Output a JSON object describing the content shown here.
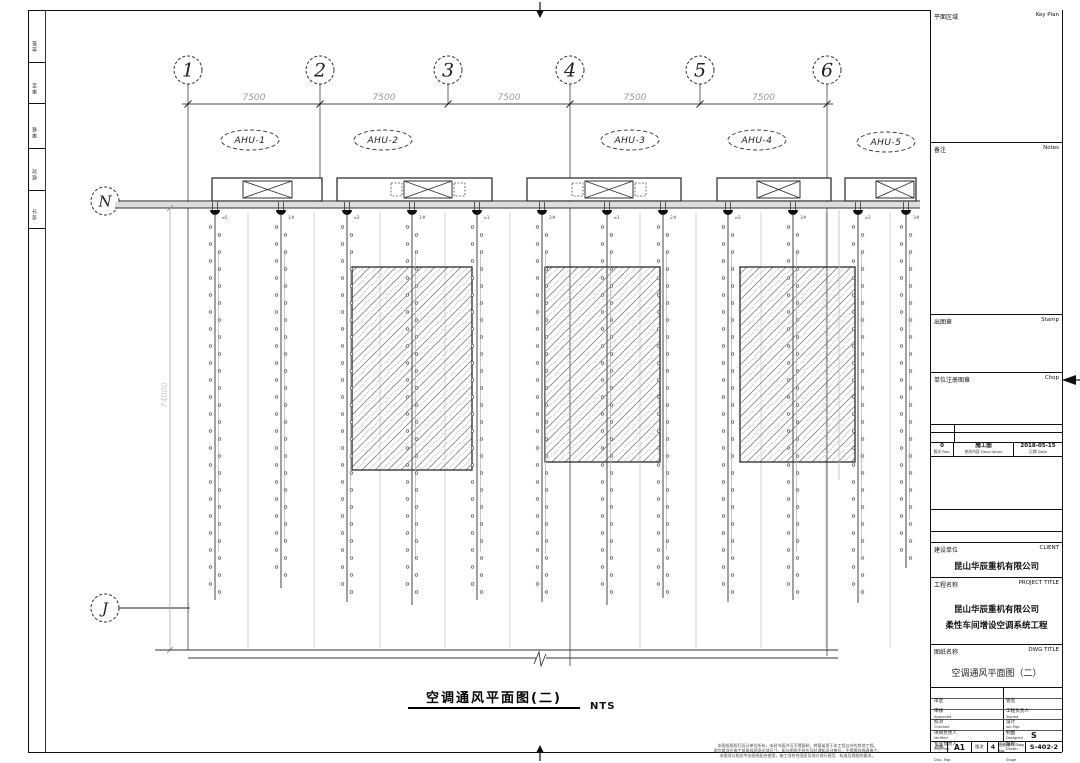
{
  "main_title": {
    "text": "空调通风平面图(二)",
    "scale": "NTS"
  },
  "margin_labels": [
    "会签",
    "审定",
    "审核",
    "校对",
    "设计"
  ],
  "plan": {
    "bubble_y": 70,
    "bubble_r": 14,
    "dim_line_y": 104,
    "grid_cols": [
      {
        "label": "1",
        "x": 188,
        "stem_to": 650
      },
      {
        "label": "2",
        "x": 320,
        "stem_to": 208
      },
      {
        "label": "3",
        "x": 448,
        "stem_to": 104
      },
      {
        "label": "4",
        "x": 570,
        "stem_to": 666
      },
      {
        "label": "5",
        "x": 700,
        "stem_to": 104
      },
      {
        "label": "6",
        "x": 827,
        "stem_to": 656
      }
    ],
    "dims": [
      {
        "text": "7500",
        "x1": 188,
        "x2": 320
      },
      {
        "text": "7500",
        "x1": 320,
        "x2": 448
      },
      {
        "text": "7500",
        "x1": 448,
        "x2": 570
      },
      {
        "text": "7500",
        "x1": 570,
        "x2": 700
      },
      {
        "text": "7500",
        "x1": 700,
        "x2": 827
      }
    ],
    "grid_rows": [
      {
        "label": "N",
        "y": 201,
        "line_x1": 119,
        "line_x2": 920
      },
      {
        "label": "J",
        "y": 608,
        "line_x1": 119,
        "line_x2": 190
      }
    ],
    "row_bubble_x": 105,
    "vert_dim": {
      "text": "74000",
      "x": 170,
      "y1": 208,
      "y2": 650,
      "ty": 395
    },
    "ahu_tags": [
      {
        "text": "AHU-1",
        "cx": 250,
        "cy": 140
      },
      {
        "text": "AHU-2",
        "cx": 383,
        "cy": 140
      },
      {
        "text": "AHU-3",
        "cx": 630,
        "cy": 140
      },
      {
        "text": "AHU-4",
        "cx": 757,
        "cy": 140
      },
      {
        "text": "AHU-5",
        "cx": 886,
        "cy": 142
      }
    ],
    "unit_y": 178,
    "unit_h": 23,
    "ahu_units": [
      {
        "x": 212,
        "w": 110,
        "fan_x": 243,
        "fan_w": 49,
        "dashed": false
      },
      {
        "x": 337,
        "w": 155,
        "fan_x": 404,
        "fan_w": 48,
        "dashed": true
      },
      {
        "x": 527,
        "w": 154,
        "fan_x": 585,
        "fan_w": 48,
        "dashed": true
      },
      {
        "x": 717,
        "w": 114,
        "fan_x": 757,
        "fan_w": 43,
        "dashed": false
      },
      {
        "x": 845,
        "w": 71,
        "fan_x": 876,
        "fan_w": 38,
        "dashed": false
      }
    ],
    "duct_y1": 210,
    "ducts": [
      {
        "x": 215,
        "y2": 600
      },
      {
        "x": 281,
        "y2": 588
      },
      {
        "x": 347,
        "y2": 602
      },
      {
        "x": 412,
        "y2": 605
      },
      {
        "x": 477,
        "y2": 600
      },
      {
        "x": 542,
        "y2": 602
      },
      {
        "x": 607,
        "y2": 605
      },
      {
        "x": 663,
        "y2": 598
      },
      {
        "x": 728,
        "y2": 602
      },
      {
        "x": 793,
        "y2": 600
      },
      {
        "x": 858,
        "y2": 603
      },
      {
        "x": 906,
        "y2": 568
      }
    ],
    "duct_tags": [
      "⌀5",
      "1#",
      "⌀2",
      "1#",
      "⌀1",
      "2#",
      "⌀1",
      "2#",
      "⌀3",
      "3#",
      "⌀3",
      "3#"
    ],
    "purlins": [
      248,
      314,
      380,
      445,
      510,
      640,
      696,
      761,
      826,
      890
    ],
    "hatches": [
      {
        "x": 352,
        "y": 267,
        "w": 120,
        "h": 203
      },
      {
        "x": 545,
        "y": 267,
        "w": 115,
        "h": 195
      },
      {
        "x": 740,
        "y": 267,
        "w": 115,
        "h": 195
      }
    ],
    "bottom_line1": {
      "y": 650,
      "x1": 155,
      "x2": 838
    },
    "bottom_line2": {
      "y": 658,
      "x1": 188,
      "x2": 838,
      "break_x": 540
    },
    "right_partial_line": {
      "x": 839,
      "y1": 210,
      "y2": 480
    }
  },
  "titleblock": {
    "keyplan": {
      "cn": "平面区域",
      "en": "Key Plan"
    },
    "notes": {
      "cn": "备注",
      "en": "Notes"
    },
    "stamp": {
      "cn": "出图章",
      "en": "Stamp"
    },
    "chop": {
      "cn": "单位注册图章",
      "en": "Chop"
    },
    "revision": {
      "row": {
        "rev": "0",
        "desc": "施工图",
        "date": "2018-05-15"
      },
      "labels": {
        "rev": "版次 Rev.",
        "desc": "修改内容 Description",
        "date": "日期 Date"
      }
    },
    "client": {
      "cn": "建设单位",
      "en": "CLIENT",
      "value": "昆山华辰重机有限公司"
    },
    "project": {
      "cn": "工程名称",
      "en": "PROJECT TITLE",
      "line1": "昆山华辰重机有限公司",
      "line2": "柔性车间增设空调系统工程"
    },
    "dwg": {
      "cn": "图纸名称",
      "en": "DWG TITLE",
      "value": "空调通风平面图（二）"
    },
    "signoff": {
      "left": [
        {
          "cn": "审定",
          "en": "Approved"
        },
        {
          "cn": "审核",
          "en": "Checked"
        },
        {
          "cn": "校对",
          "en": "Verified"
        },
        {
          "cn": "项目负责人",
          "en": "Proj. Mgr."
        },
        {
          "cn": "专业负责人",
          "en": "Disc. Mgr."
        }
      ],
      "right": [
        {
          "cn": "会签",
          "en": "Signed"
        },
        {
          "cn": "工程负责人",
          "en": "Job Mgr."
        },
        {
          "cn": "设计",
          "en": "Designed"
        },
        {
          "cn": "制图",
          "en": "Drawn"
        },
        {
          "cn": "阶段",
          "en": "Stage"
        }
      ],
      "stage_value": "S",
      "size_label": "图幅",
      "size_value": "A1",
      "rev_label": "版次",
      "rev_value": "4",
      "dwgno_label": "图纸编号 Dwg No.",
      "dwgno_value": "S-402-2"
    },
    "disclaimer": [
      "本图纸版权归设计单位所有，未经书面许可不得复制、转载或用于本工程以外的其他工程。",
      "承包商须在施工前复核现场全部尺寸，如与图纸不符应及时通知设计单位，不得擅自修改施工。",
      "本图须与相关专业图纸配合使用，施工须符合国家及地方现行规范、标准及规程的要求。"
    ]
  }
}
